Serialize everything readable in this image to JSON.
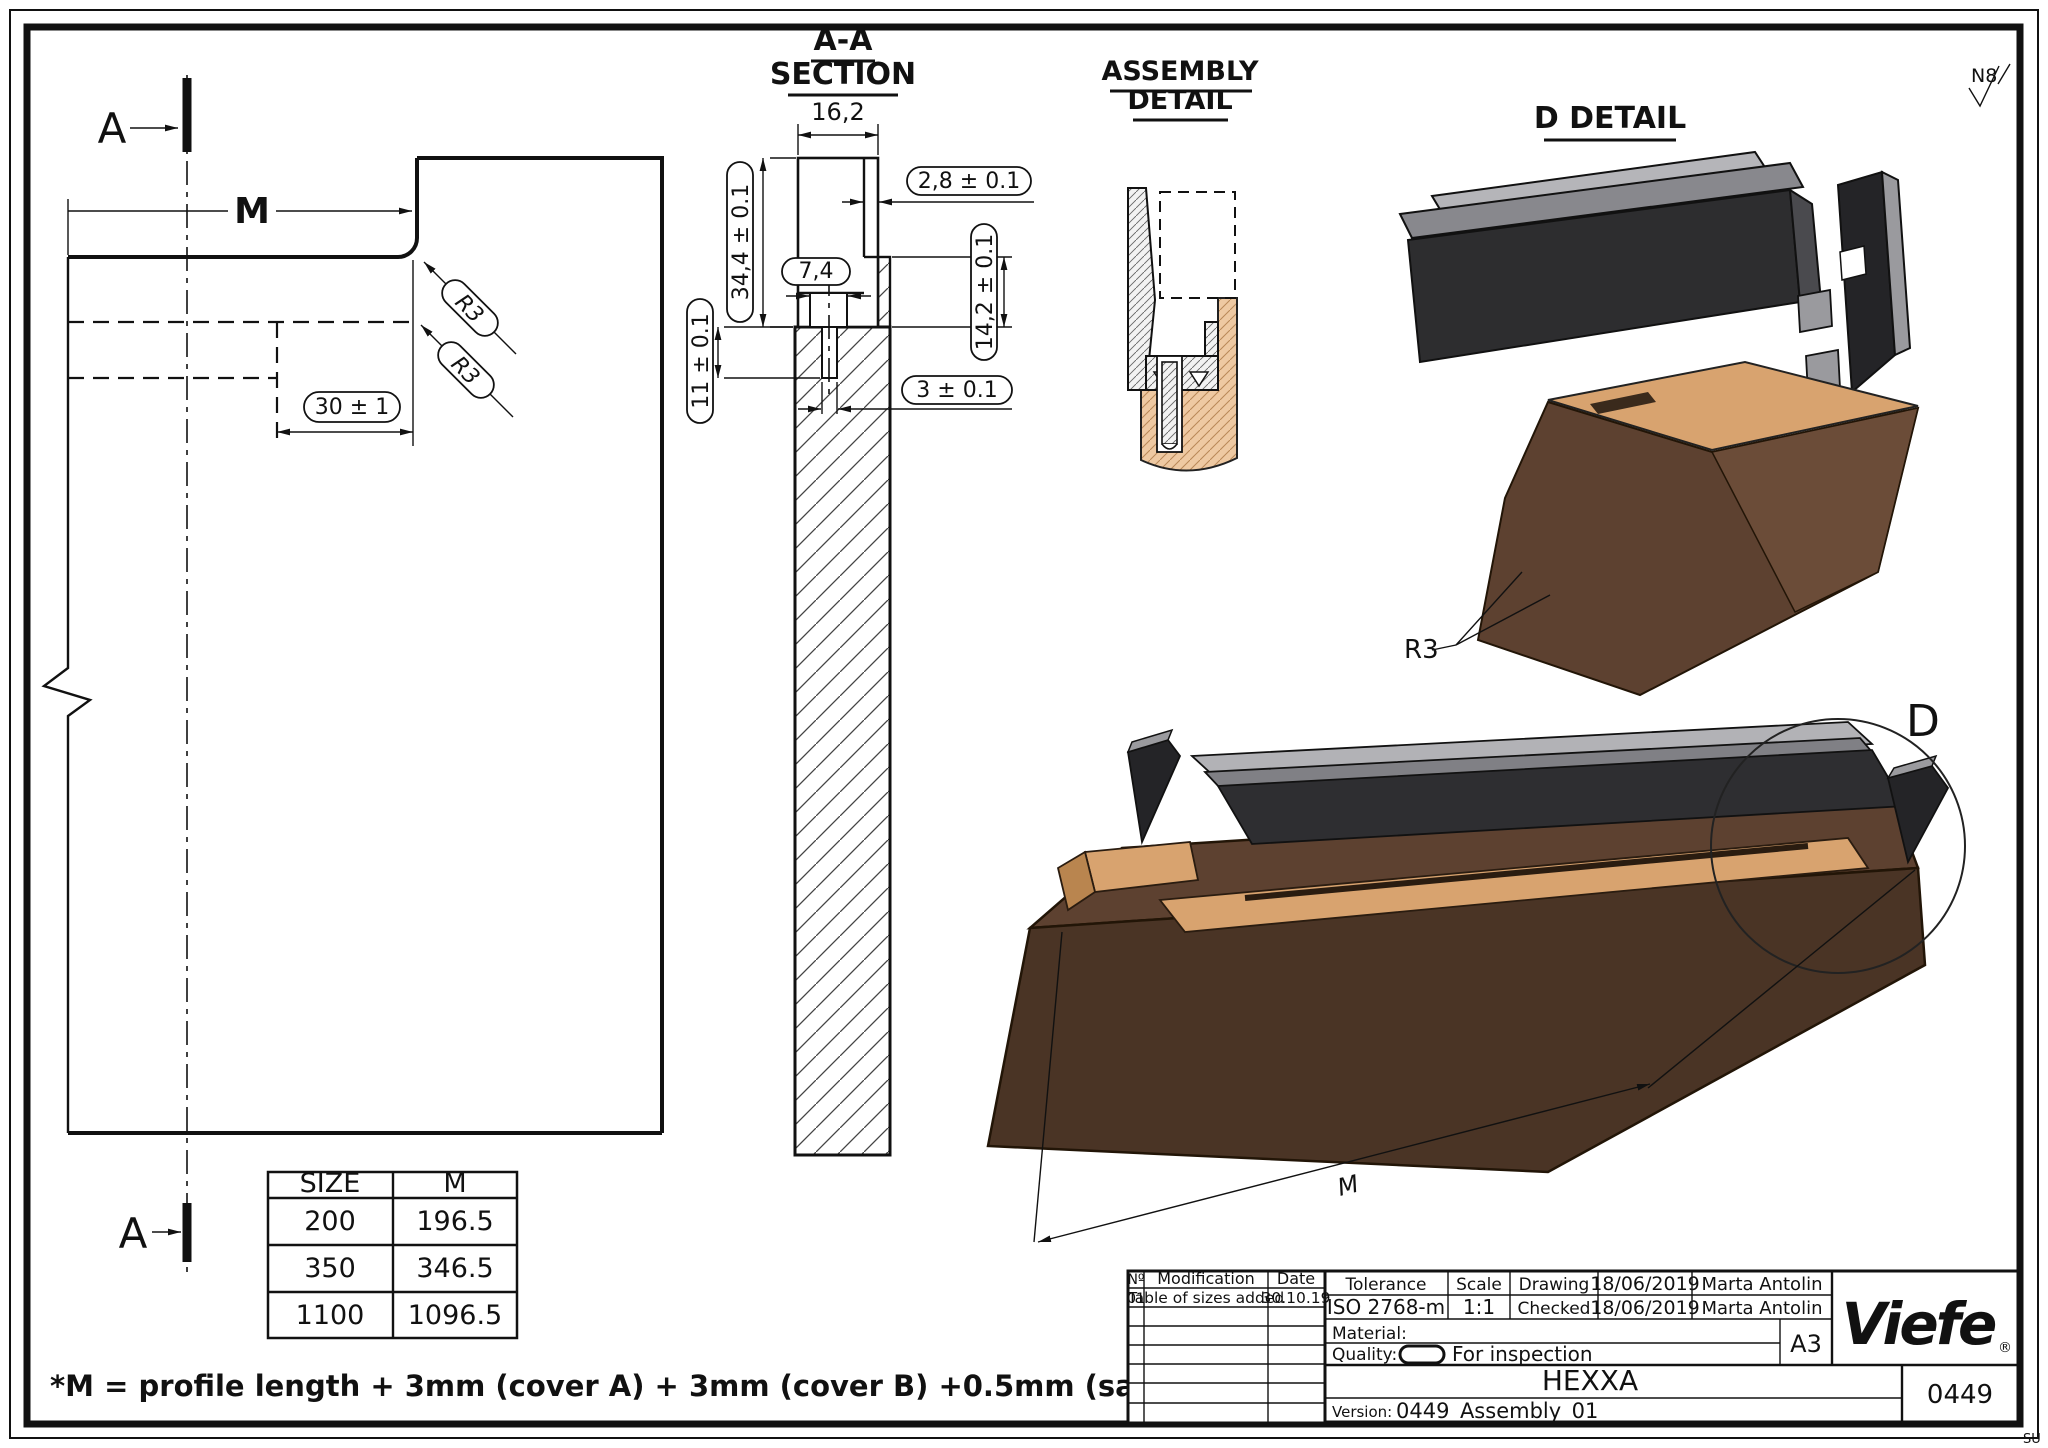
{
  "sheet": {
    "watermark": "SU"
  },
  "surface_finish": {
    "label": "N8"
  },
  "left_view": {
    "section_mark_top": "A",
    "section_mark_bottom": "A",
    "m_label": "M",
    "r3_upper": "R3",
    "r3_lower": "R3",
    "dim_30": "30 ± 1"
  },
  "aa_section": {
    "title_line1": "A-A",
    "title_line2": "SECTION",
    "dim_width": "16,2",
    "dim_wall": "2,8 ± 0.1",
    "dim_height": "34,4 ± 0.1",
    "dim_recess": "7,4",
    "dim_lip": "14,2 ± 0.1",
    "dim_depth": "11 ± 0.1",
    "dim_slot": "3 ± 0.1"
  },
  "assembly_detail": {
    "title_line1": "ASSEMBLY",
    "title_line2": "DETAIL"
  },
  "d_detail": {
    "title": "D DETAIL",
    "r3_label": "R3",
    "circle_label": "D",
    "m_label": "M"
  },
  "size_table": {
    "headers": [
      "SIZE",
      "M"
    ],
    "rows": [
      [
        "200",
        "196.5"
      ],
      [
        "350",
        "346.5"
      ],
      [
        "1100",
        "1096.5"
      ]
    ]
  },
  "note": "*M = profile length + 3mm (cover A) + 3mm (cover B) +0.5mm (safety)",
  "title_block": {
    "revision": {
      "col_no": "Nº",
      "col_modification": "Modification",
      "col_date": "Date",
      "row_no": "01",
      "row_modification": "Table of sizes added",
      "row_date": "30.10.19"
    },
    "tolerance_label": "Tolerance",
    "tolerance_value": "ISO 2768-m",
    "scale_label": "Scale",
    "scale_value": "1:1",
    "drawing_label": "Drawing",
    "drawing_date": "18/06/2019",
    "drawing_author": "Marta Antolin",
    "checked_label": "Checked",
    "checked_date": "18/06/2019",
    "checked_author": "Marta Antolin",
    "material_label": "Material:",
    "quality_label": "Quality:",
    "quality_value": "For inspection",
    "product_name": "HEXXA",
    "version_label": "Version:",
    "version_value": "0449_Assembly_01",
    "paper_size": "A3",
    "drawing_number": "0449",
    "brand": "Viefe",
    "brand_r": "®"
  }
}
